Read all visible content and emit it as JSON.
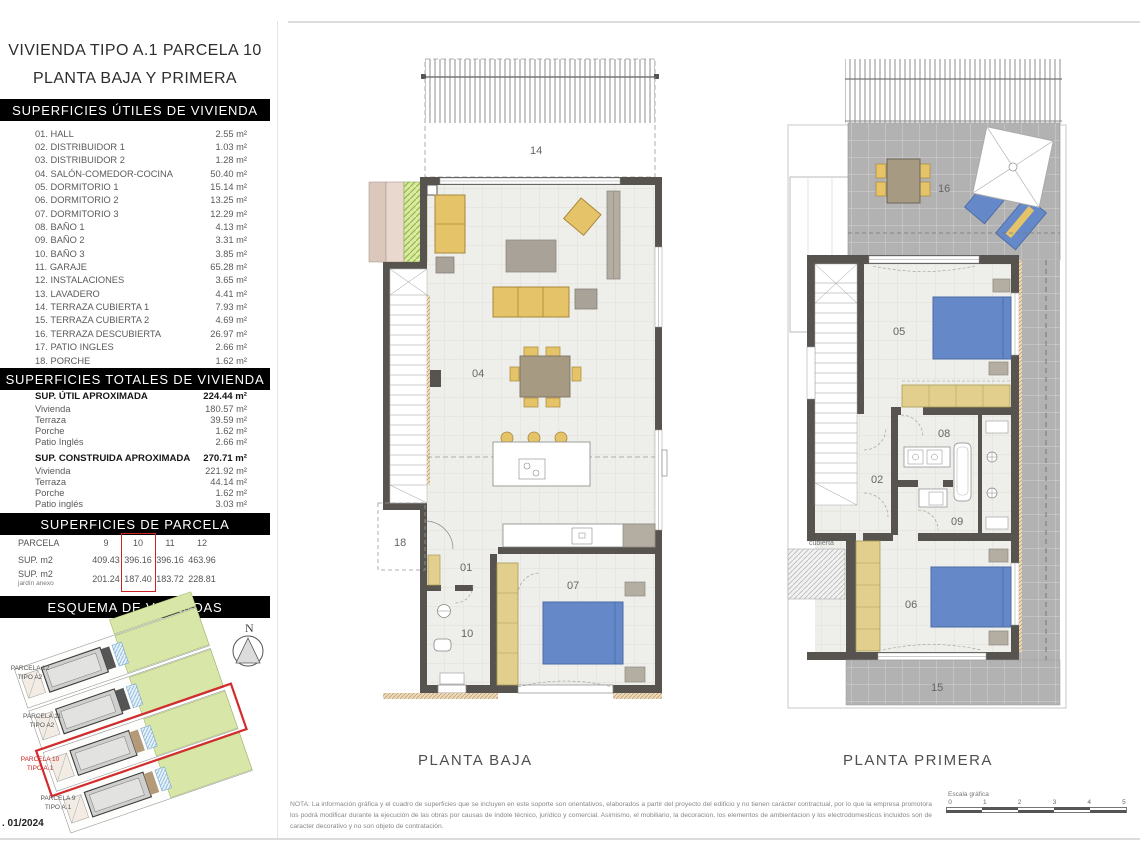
{
  "page": {
    "background": "#ffffff",
    "accent_red": "#cc2222",
    "wall_color": "#57544f",
    "furniture_yellow": "#e5c469",
    "furniture_gray": "#a8a299",
    "bed_blue": "#6488c8"
  },
  "title": {
    "line1": "VIVIENDA TIPO A.1 PARCELA 10",
    "line2": "PLANTA BAJA Y PRIMERA"
  },
  "sections": {
    "utiles": {
      "title": "SUPERFICIES ÚTILES DE VIVIENDA",
      "rows": [
        {
          "label": "01. HALL",
          "value": "2.55 m²"
        },
        {
          "label": "02. DISTRIBUIDOR 1",
          "value": "1.03 m²"
        },
        {
          "label": "03. DISTRIBUIDOR 2",
          "value": "1.28 m²"
        },
        {
          "label": "04. SALÓN-COMEDOR-COCINA",
          "value": "50.40 m²"
        },
        {
          "label": "05. DORMITORIO 1",
          "value": "15.14 m²"
        },
        {
          "label": "06. DORMITORIO 2",
          "value": "13.25 m²"
        },
        {
          "label": "07. DORMITORIO 3",
          "value": "12.29 m²"
        },
        {
          "label": "08. BAÑO 1",
          "value": "4.13 m²"
        },
        {
          "label": "09. BAÑO 2",
          "value": "3.31 m²"
        },
        {
          "label": "10. BAÑO 3",
          "value": "3.85 m²"
        },
        {
          "label": "11. GARAJE",
          "value": "65.28 m²"
        },
        {
          "label": "12. INSTALACIONES",
          "value": "3.65 m²"
        },
        {
          "label": "13. LAVADERO",
          "value": "4.41 m²"
        },
        {
          "label": "14. TERRAZA CUBIERTA 1",
          "value": "7.93 m²"
        },
        {
          "label": "15. TERRAZA CUBIERTA 2",
          "value": "4.69 m²"
        },
        {
          "label": "16. TERRAZA DESCUBIERTA",
          "value": "26.97 m²"
        },
        {
          "label": "17. PATIO INGLES",
          "value": "2.66 m²"
        },
        {
          "label": "18. PORCHE",
          "value": "1.62 m²"
        }
      ]
    },
    "totales": {
      "title": "SUPERFICIES TOTALES DE VIVIENDA",
      "groups": [
        {
          "label": "SUP. ÚTIL APROXIMADA",
          "value": "224.44 m²",
          "rows": [
            {
              "label": "Vivienda",
              "value": "180.57 m²"
            },
            {
              "label": "Terraza",
              "value": "39.59 m²"
            },
            {
              "label": "Porche",
              "value": "1.62 m²"
            },
            {
              "label": "Patio Inglés",
              "value": "2.66 m²"
            }
          ]
        },
        {
          "label": "SUP. CONSTRUIDA APROXIMADA",
          "value": "270.71 m²",
          "rows": [
            {
              "label": "Vivienda",
              "value": "221.92 m²"
            },
            {
              "label": "Terraza",
              "value": "44.14 m²"
            },
            {
              "label": "Porche",
              "value": "1.62 m²"
            },
            {
              "label": "Patio inglés",
              "value": "3.03 m²"
            }
          ]
        }
      ]
    },
    "parcela": {
      "title": "SUPERFICIES DE PARCELA",
      "row1_label": "PARCELA",
      "row2_label": "SUP. m2",
      "row3_label": "SUP. m2",
      "row3_sublabel": "jardín anexo",
      "columns": [
        {
          "num": "9",
          "sup": "409.43",
          "jardin": "201.24"
        },
        {
          "num": "10",
          "sup": "396.16",
          "jardin": "187.40"
        },
        {
          "num": "11",
          "sup": "396.16",
          "jardin": "183.72"
        },
        {
          "num": "12",
          "sup": "463.96",
          "jardin": "228.81"
        }
      ],
      "highlighted_column": "10"
    },
    "esquema": {
      "title": "ESQUEMA DE VIVIENDAS",
      "north": "N",
      "date": ". 01/2024",
      "parcels": [
        {
          "name": "PARCELA 12",
          "tipo": "TIPO A2"
        },
        {
          "name": "PARCELA 11",
          "tipo": "TIPO A2"
        },
        {
          "name": "PARCELA 10",
          "tipo": "TIPO A.1"
        },
        {
          "name": "PARCELA 9",
          "tipo": "TIPO A.1"
        }
      ]
    }
  },
  "plans": {
    "baja": {
      "caption": "PLANTA BAJA",
      "rooms": {
        "r14": "14",
        "r04": "04",
        "r18": "18",
        "r01": "01",
        "r10": "10",
        "r07": "07"
      }
    },
    "primera": {
      "caption": "PLANTA PRIMERA",
      "rooms": {
        "r16": "16",
        "r05": "05",
        "r02": "02",
        "r08": "08",
        "r09": "09",
        "r06": "06",
        "r15": "15",
        "cubierta": "cubierta"
      }
    }
  },
  "footer": {
    "note": "NOTA: La información gráfica y el cuadro de superficies que se incluyen en este soporte son orientativos, elaborados a partir del proyecto del edificio y no tienen carácter contractual, por lo que la empresa promotora los podrá modificar durante la ejecución de las obras por causas de índole técnico, jurídico y comercial. Asimismo, el mobiliario, la decoracion, los elementos de ambientacion y los electrodomesticos incluidos son de caracter decorativo y no son objeto de contratación.",
    "scale_label": "Escala gráfica",
    "scale_ticks": [
      "0",
      "1",
      "2",
      "3",
      "4",
      "5"
    ]
  }
}
